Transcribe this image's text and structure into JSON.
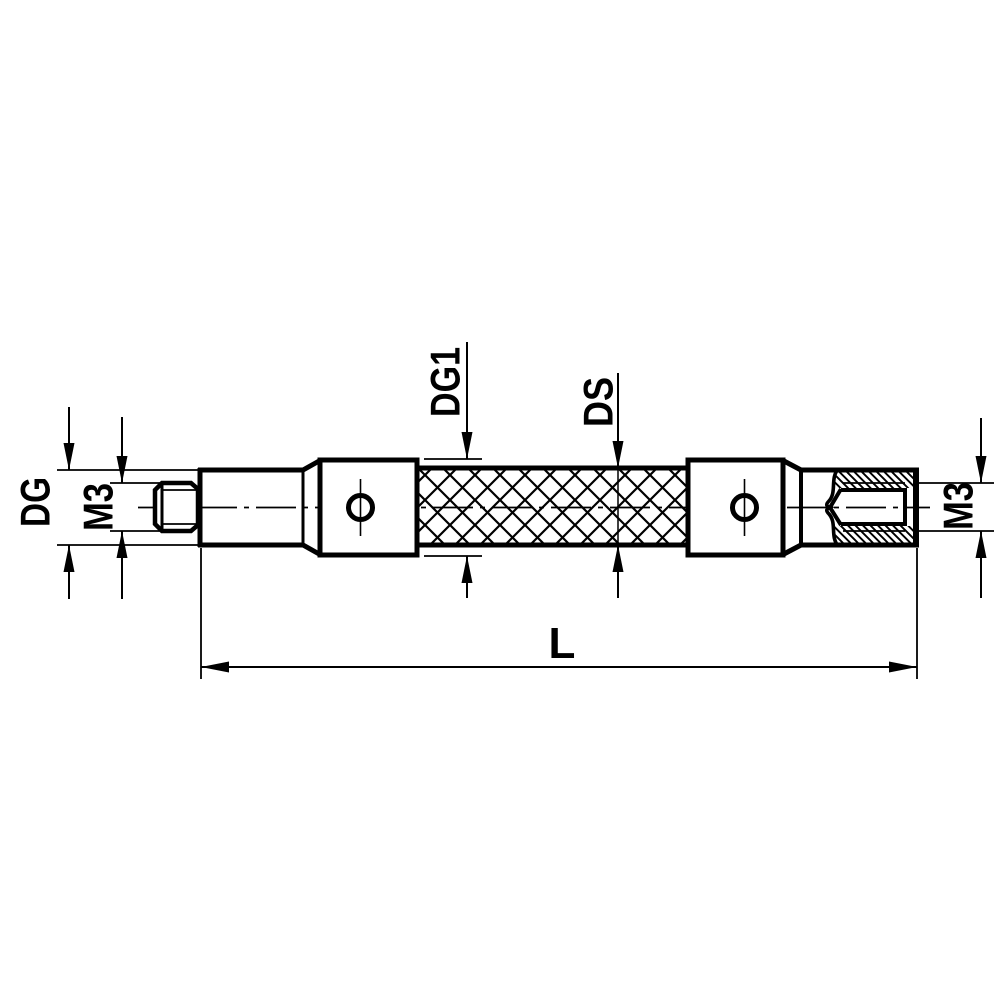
{
  "drawing": {
    "background_color": "#ffffff",
    "line_color": "#000000",
    "labels": {
      "dg": "DG",
      "m3_left": "M3",
      "dg1": "DG1",
      "ds": "DS",
      "m3_right": "M3",
      "l": "L"
    }
  }
}
